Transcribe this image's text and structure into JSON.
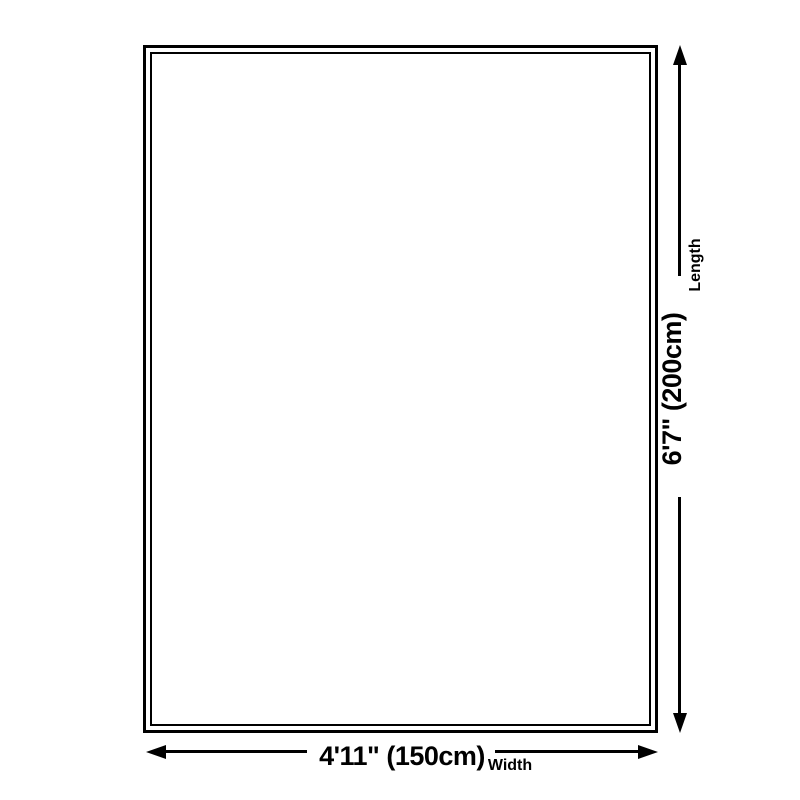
{
  "colors": {
    "background": "#ffffff",
    "line": "#000000",
    "text": "#000000"
  },
  "dimensions": {
    "length": {
      "value": "6'7\" (200cm)",
      "label": "Length"
    },
    "width": {
      "value": "4'11\" (150cm)",
      "label": "Width"
    }
  },
  "icons": {
    "vertical_arrow": "double-headed-arrow-vertical",
    "horizontal_arrow": "double-headed-arrow-horizontal"
  }
}
